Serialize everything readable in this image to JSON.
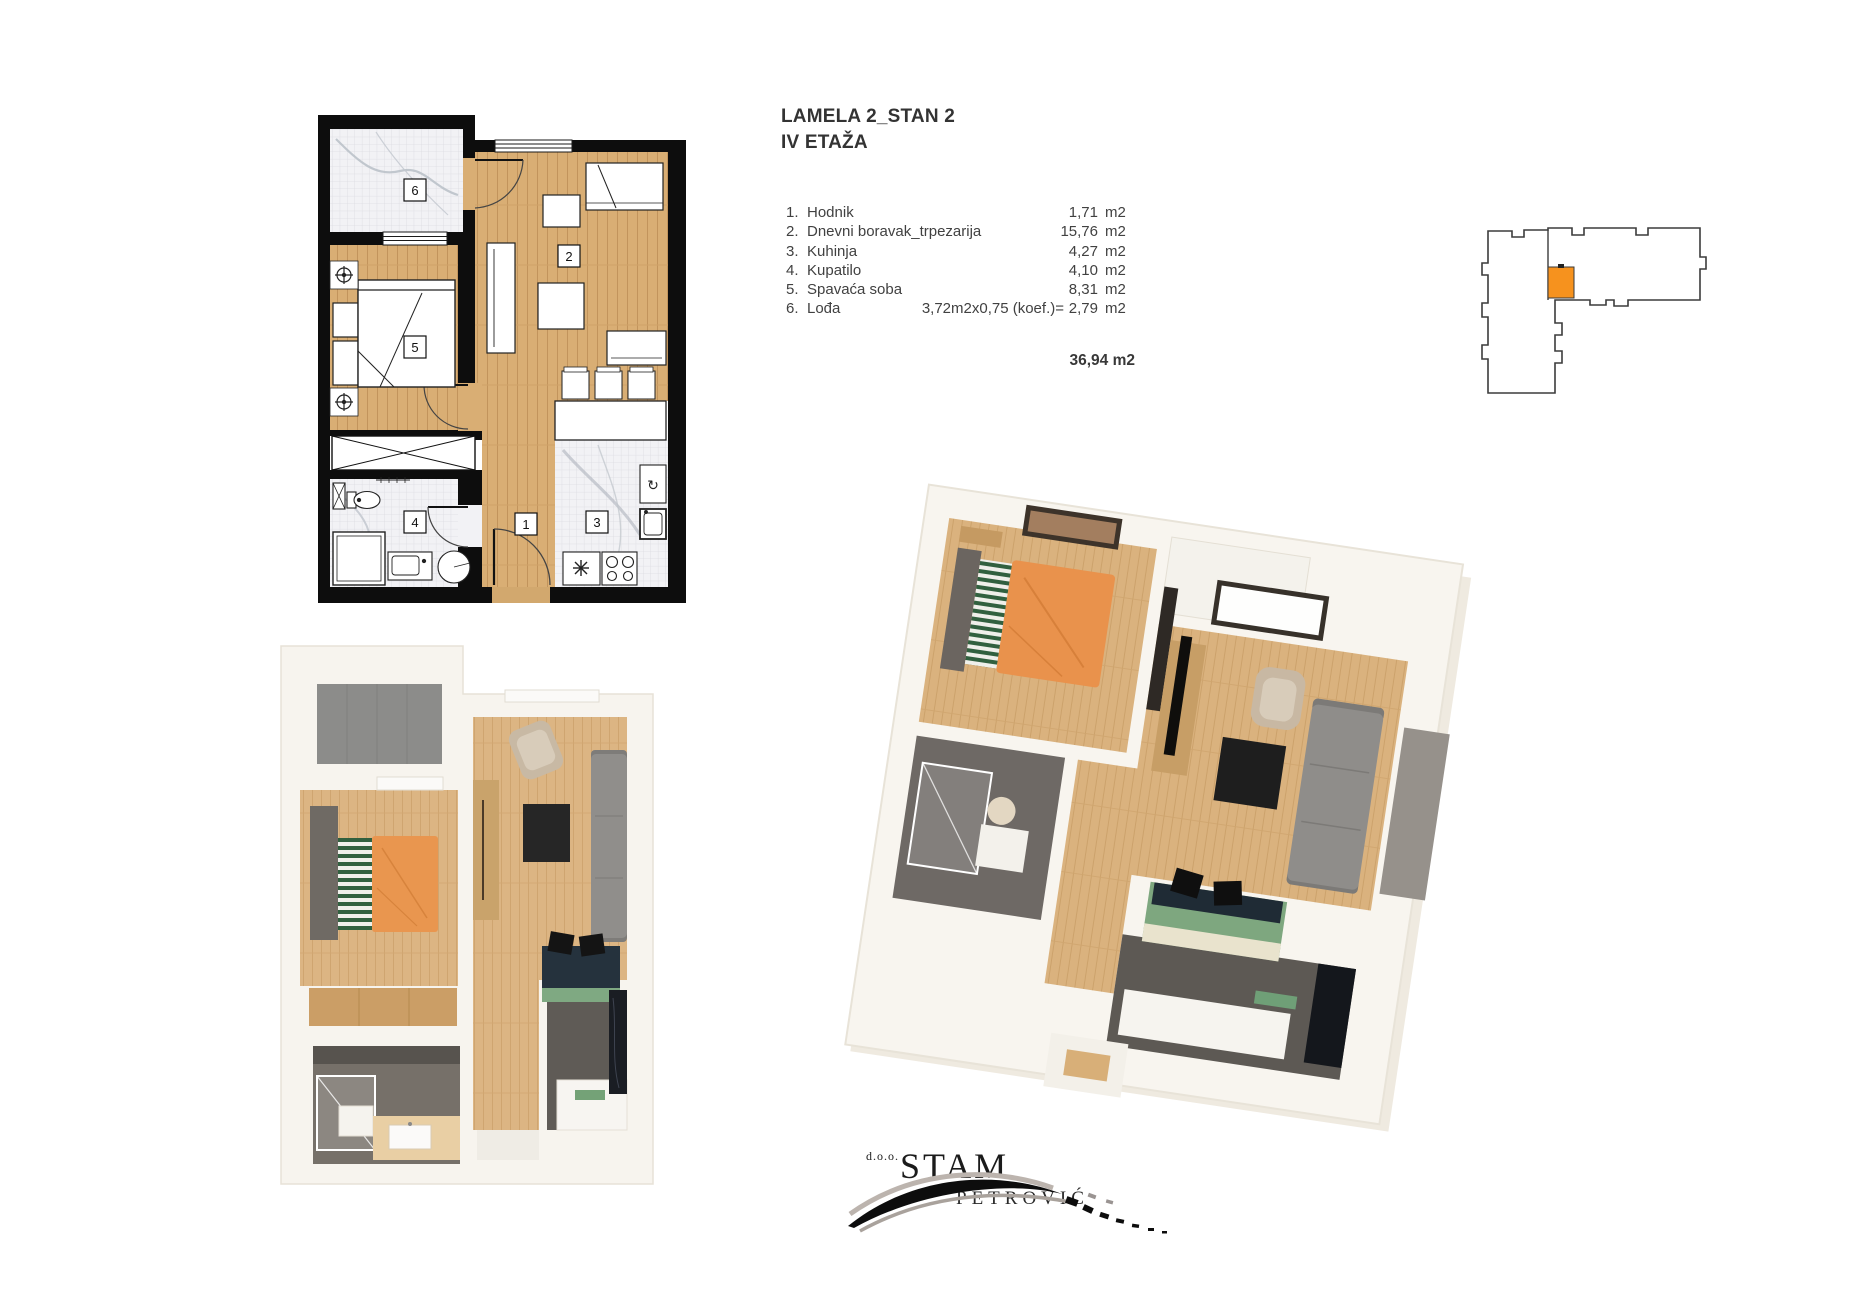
{
  "header": {
    "project": "LAMELA 2_STAN 2",
    "floor": "IV ETAŽA"
  },
  "rooms": {
    "rows": [
      {
        "num": "1.",
        "name": "Hodnik",
        "note": "",
        "value": "1,71",
        "unit": "m2"
      },
      {
        "num": "2.",
        "name": "Dnevni boravak_trpezarija",
        "note": "",
        "value": "15,76",
        "unit": "m2"
      },
      {
        "num": "3.",
        "name": "Kuhinja",
        "note": "",
        "value": "4,27",
        "unit": "m2"
      },
      {
        "num": "4.",
        "name": "Kupatilo",
        "note": "",
        "value": "4,10",
        "unit": "m2"
      },
      {
        "num": "5.",
        "name": "Spavaća soba",
        "note": "",
        "value": "8,31",
        "unit": "m2"
      },
      {
        "num": "6.",
        "name": "Lođa",
        "note": "3,72m2x0,75 (koef.)=",
        "value": "2,79",
        "unit": "m2"
      }
    ],
    "total": "36,94 m2"
  },
  "plan_labels": {
    "loggia": "6",
    "living": "2",
    "bedroom": "5",
    "bathroom": "4",
    "hall": "1",
    "kitchen": "3"
  },
  "logo": {
    "prefix": "d.o.o.",
    "name": "STAM",
    "surname": "PETROVIĆ"
  },
  "colors": {
    "unit_highlight_orange": "#F6921E",
    "wall_black": "#0D0D0D",
    "wood_floor": "#D9AE74",
    "tile_floor": "#F2F2F5",
    "bed_orange": "#E9964F",
    "pillow_green": "#31603F",
    "sideboard_green": "#7EA77F",
    "sofa_gray": "#908E8B",
    "text_gray": "#414141"
  }
}
